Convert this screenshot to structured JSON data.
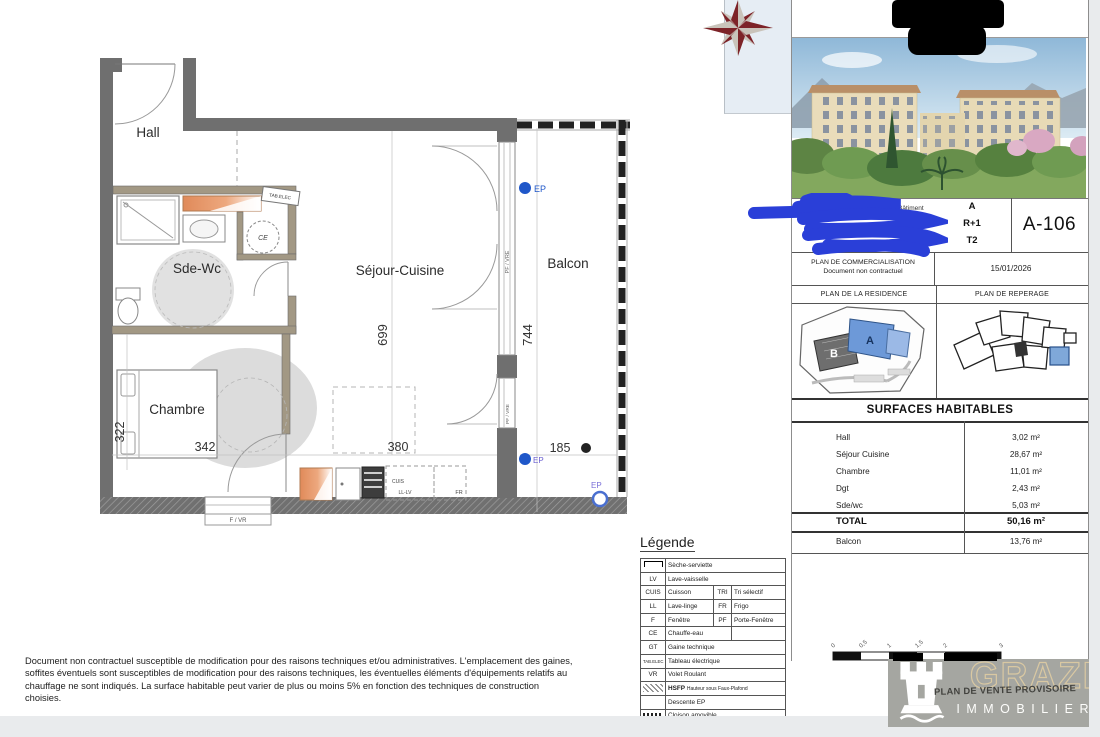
{
  "plan": {
    "rooms": {
      "hall": "Hall",
      "sde_wc": "Sde-Wc",
      "sejour": "Séjour-Cuisine",
      "chambre": "Chambre",
      "balcon": "Balcon"
    },
    "dims": {
      "sejour_h": "699",
      "balcon_h": "744",
      "chambre_h": "322",
      "chambre_w": "342",
      "kitchen_w": "380",
      "balcon_w": "185"
    },
    "labels": {
      "tab_elec": "TAB.ELEC",
      "ce": "CE",
      "cuis": "CUIS",
      "ll_lv": "LL-LV",
      "fr": "FR",
      "f_vr": "F / VR",
      "pf_vre": "PF / VRE",
      "ep": "EP"
    }
  },
  "panel": {
    "info": {
      "batiment_label": "Bâtiment",
      "batiment": "A",
      "niveau_label": "Niveau",
      "niveau": "R+1",
      "type_label": "Type",
      "type": "T2",
      "lot": "A-106",
      "doc_title": "PLAN DE COMMERCIALISATION",
      "doc_subtitle": "Document non contractuel",
      "date": "15/01/2026"
    },
    "residence_header": "PLAN DE LA RESIDENCE",
    "reperage_header": "PLAN DE REPERAGE",
    "residence_labels": {
      "a": "A",
      "b": "B"
    },
    "surfaces": {
      "title": "SURFACES HABITABLES",
      "rows": [
        {
          "label": "Hall",
          "value": "3,02 m²"
        },
        {
          "label": "Séjour Cuisine",
          "value": "28,67 m²"
        },
        {
          "label": "Chambre",
          "value": "11,01 m²"
        },
        {
          "label": "Dgt",
          "value": "2,43 m²"
        },
        {
          "label": "Sde/wc",
          "value": "5,03 m²"
        }
      ],
      "total_label": "TOTAL",
      "total_value": "50,16 m²",
      "balcon_label": "Balcon",
      "balcon_value": "13,76 m²"
    }
  },
  "legend": {
    "title": "Légende",
    "rows": [
      {
        "abbr": "",
        "label": "Sèche-serviette"
      },
      {
        "abbr": "LV",
        "label": "Lave-vaisselle"
      },
      {
        "abbr": "CUIS",
        "label": "Cuisson",
        "abbr2": "TRI",
        "label2": "Tri sélectif"
      },
      {
        "abbr": "LL",
        "label": "Lave-linge",
        "abbr2": "FR",
        "label2": "Frigo"
      },
      {
        "abbr": "F",
        "label": "Fenêtre",
        "abbr2": "PF",
        "label2": "Porte-Fenêtre"
      },
      {
        "abbr": "CE",
        "label": "Chauffe-eau"
      },
      {
        "abbr": "GT",
        "label": "Gaine technique"
      },
      {
        "abbr": "TAB.ELEC",
        "label": "Tableau électrique"
      },
      {
        "abbr": "VR",
        "label": "Volet Roulant"
      },
      {
        "abbr": "HSFP",
        "label": "Hauteur sous Faux-Plafond"
      },
      {
        "abbr": "",
        "label": "Descente EP"
      },
      {
        "abbr": "",
        "label": "Cloison amovible"
      }
    ]
  },
  "scalebar": {
    "labels": [
      "0",
      "0,5",
      "1",
      "1,5",
      "2",
      "3"
    ]
  },
  "disclaimer": "Document non contractuel susceptible de modification pour des raisons techniques et/ou administratives. L'emplacement des gaines, soffites éventuels sont susceptibles de modification pour des raisons techniques, les éventuelles éléments d'équipements relatifs au chauffage ne sont indiqués. La surface habitable peut varier de plus ou moins 5% en fonction des techniques de construction choisies.",
  "logo": {
    "brand": "GRAZI",
    "subtitle": "IMMOBILIER",
    "stamp": "PLAN DE VENTE PROVISOIRE"
  },
  "colors": {
    "ep_blue": "#1f57c9",
    "scribble_blue": "#2a3fd8",
    "radiator_orange": "#e08a5a",
    "wall_gray": "#6f6f6f",
    "partition_tan": "#a29884",
    "highlight_blue": "#6d99d8",
    "logo_bg": "#a5a6a1",
    "logo_gold": "#d9c8a2"
  }
}
